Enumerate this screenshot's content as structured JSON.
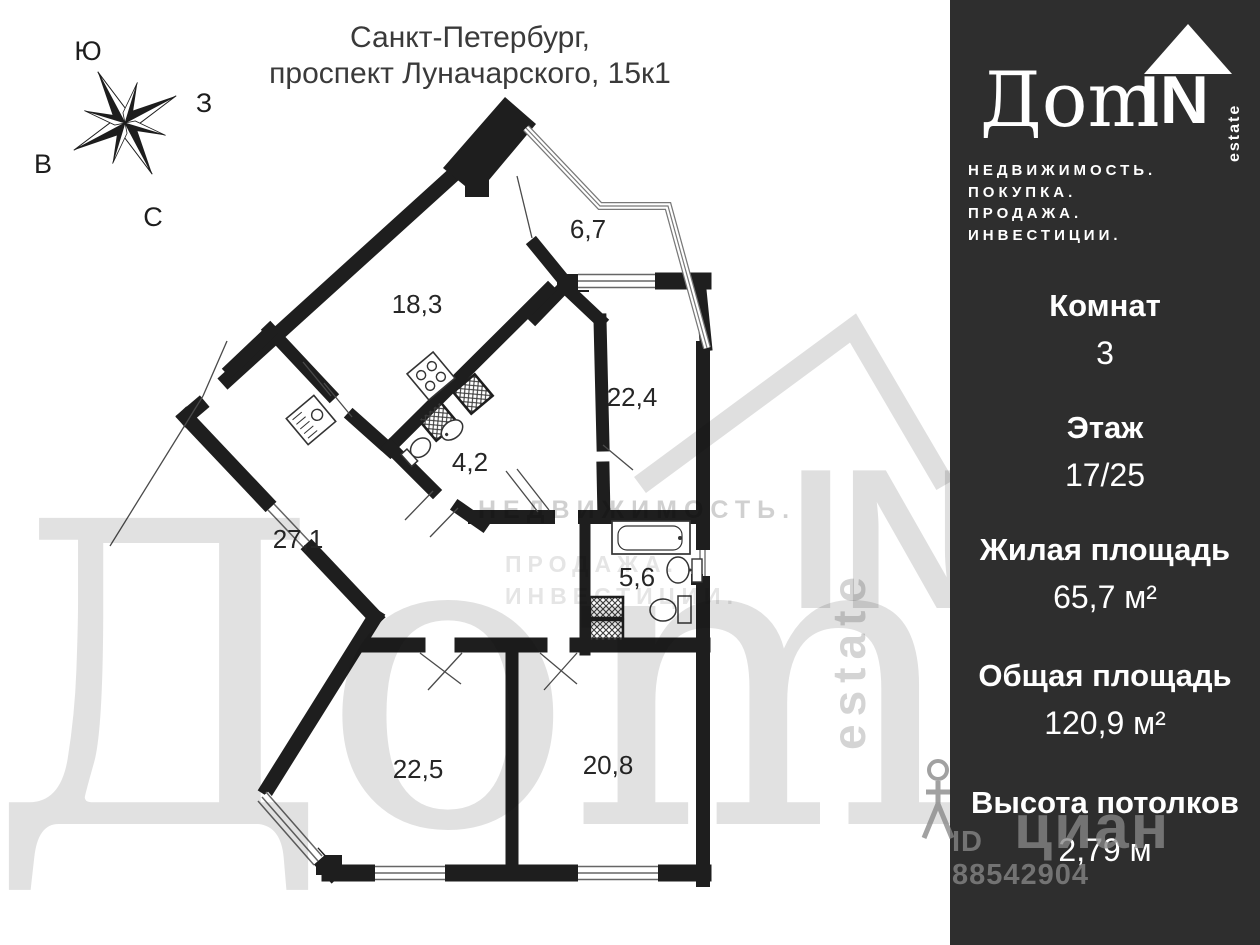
{
  "title": {
    "line1": "Санкт-Петербург,",
    "line2": "проспект Луначарского, 15к1"
  },
  "compass": {
    "top": "Ю",
    "right": "З",
    "left": "В",
    "bottom": "С"
  },
  "plan": {
    "areas": [
      "6,7",
      "18,3",
      "22,4",
      "4,2",
      "27,1",
      "5,6",
      "22,5",
      "20,8"
    ]
  },
  "watermarks": {
    "brand_word": "Дom",
    "brand_in": "IN",
    "brand_estate": "estate",
    "brand_line1": "НЕДВИЖИМОСТЬ.",
    "brand_line2": "ПРОДАЖА.",
    "brand_line3": "ИНВЕСТИЦИИ.",
    "cian_text": "циан",
    "cian_id": "ID 88542904"
  },
  "sidebar": {
    "logo": {
      "dom": "Дom",
      "in": "IN",
      "estate": "estate"
    },
    "tagline": [
      "НЕДВИЖИМОСТЬ.",
      "ПОКУПКА.",
      "ПРОДАЖА.",
      "ИНВЕСТИЦИИ."
    ],
    "stats": [
      {
        "label": "Комнат",
        "value": "3"
      },
      {
        "label": "Этаж",
        "value": "17/25"
      },
      {
        "label": "Жилая площадь",
        "value": "65,7 м²"
      },
      {
        "label": "Общая площадь",
        "value": "120,9 м²"
      },
      {
        "label": "Высота потолков",
        "value": "2,79 м"
      }
    ]
  },
  "colors": {
    "sidebar_bg": "#2e2e2e",
    "wall": "#1e1e1e",
    "text": "#3a3a3a"
  }
}
